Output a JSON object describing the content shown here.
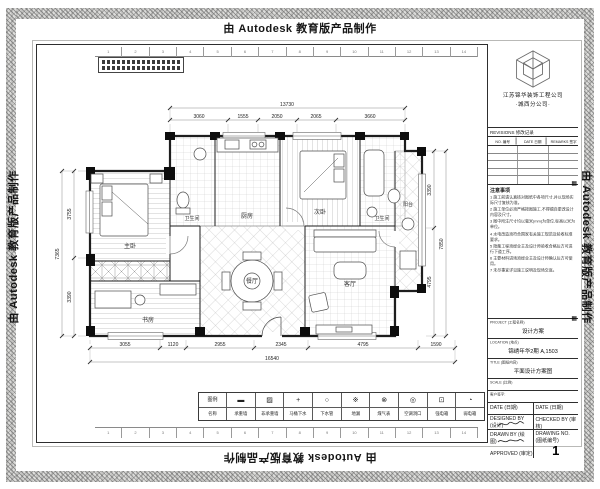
{
  "watermark": {
    "text": "由 Autodesk 教育版产品制作"
  },
  "sheet": {
    "ruler_numbers": [
      "1",
      "2",
      "3",
      "4",
      "5",
      "6",
      "7",
      "8",
      "9",
      "10",
      "11",
      "12",
      "13",
      "14"
    ]
  },
  "titleblock": {
    "logo_icon": "cube-logo",
    "company_line1": "江苏锦华装饰工程公司",
    "company_line2": "·城西分公司·",
    "revisions": {
      "title": "REVISIONS 修改记录",
      "col_no": "NO. 编号",
      "col_date": "DATE 日期",
      "col_remarks": "REMARKS 签字",
      "rows": [
        "",
        "",
        "",
        "",
        ""
      ]
    },
    "notes": {
      "title": "注意事项",
      "items": [
        "1  施工前请认真核对图纸中各项尺寸,并以现场实际尺寸复核为准。",
        "2  施工单位必须严格按图施工,不得擅自更改设计内容及尺寸。",
        "3  图中所注尺寸均以毫米(mm)为单位,标高以米为单位。",
        "4  水电改造须符合国家有关施工规范及验收标准要求。",
        "5  隐蔽工程须经业主及设计师验收合格后方可进行下道工序。",
        "6  主要材料进场须经业主及设计师确认后方可使用。",
        "7  未尽事宜详见施工说明及现场交底。"
      ]
    },
    "fields": {
      "project_label": "PROJECT (工程名称)",
      "project_value": "设计方案",
      "location_label": "LOCATION (地点)",
      "location_value": "锦绣年华2期 A,1503",
      "title_label": "TITLE (图纸内容)",
      "title_value": "平面设计方案图",
      "scale_label": "SCALE (比例)",
      "scale_value": "",
      "client_sign_label": "客户签字:",
      "date_label": "DATE (日期)",
      "date2_label": "DATE (日期)",
      "designed_label": "DESIGNED BY (设计)",
      "checked_label": "CHECKED BY (审核)",
      "drawn_label": "DRAWN BY (绘图)",
      "approved_label": "APPROVED (审定)",
      "drawing_no_label": "DRAWING NO. (图纸编号)",
      "drawing_no_value": "1"
    }
  },
  "plan": {
    "rooms": {
      "master": "主卧",
      "bed2": "次卧",
      "study": "书房",
      "dining": "餐厅",
      "living": "客厅",
      "kitchen": "厨房",
      "bath1": "卫生间",
      "bath2": "卫生间",
      "balcony": "阳台"
    },
    "dims": {
      "top_total": "13730",
      "top": [
        "3060",
        "1555",
        "2050",
        "2065",
        "3660"
      ],
      "bottom": [
        "3055",
        "1120",
        "2955",
        "2345",
        "4795",
        "1590"
      ],
      "bottom_total": "16540",
      "left": [
        "3755",
        "3390"
      ],
      "left_total": "7365",
      "right": [
        "3390",
        "4795"
      ],
      "right_total": "7850"
    }
  },
  "legend": {
    "header_symbol": "图例",
    "header_name": "名称",
    "items": [
      {
        "symbol": "▬",
        "label": "承重墙"
      },
      {
        "symbol": "▨",
        "label": "非承重墙"
      },
      {
        "symbol": "+",
        "label": "马桶下水"
      },
      {
        "symbol": "○",
        "label": "下水管"
      },
      {
        "symbol": "※",
        "label": "地漏"
      },
      {
        "symbol": "⊗",
        "label": "煤气表"
      },
      {
        "symbol": "◎",
        "label": "空调洞口"
      },
      {
        "symbol": "⊡",
        "label": "强电箱"
      },
      {
        "symbol": "◔",
        "label": "弱电箱"
      }
    ]
  }
}
